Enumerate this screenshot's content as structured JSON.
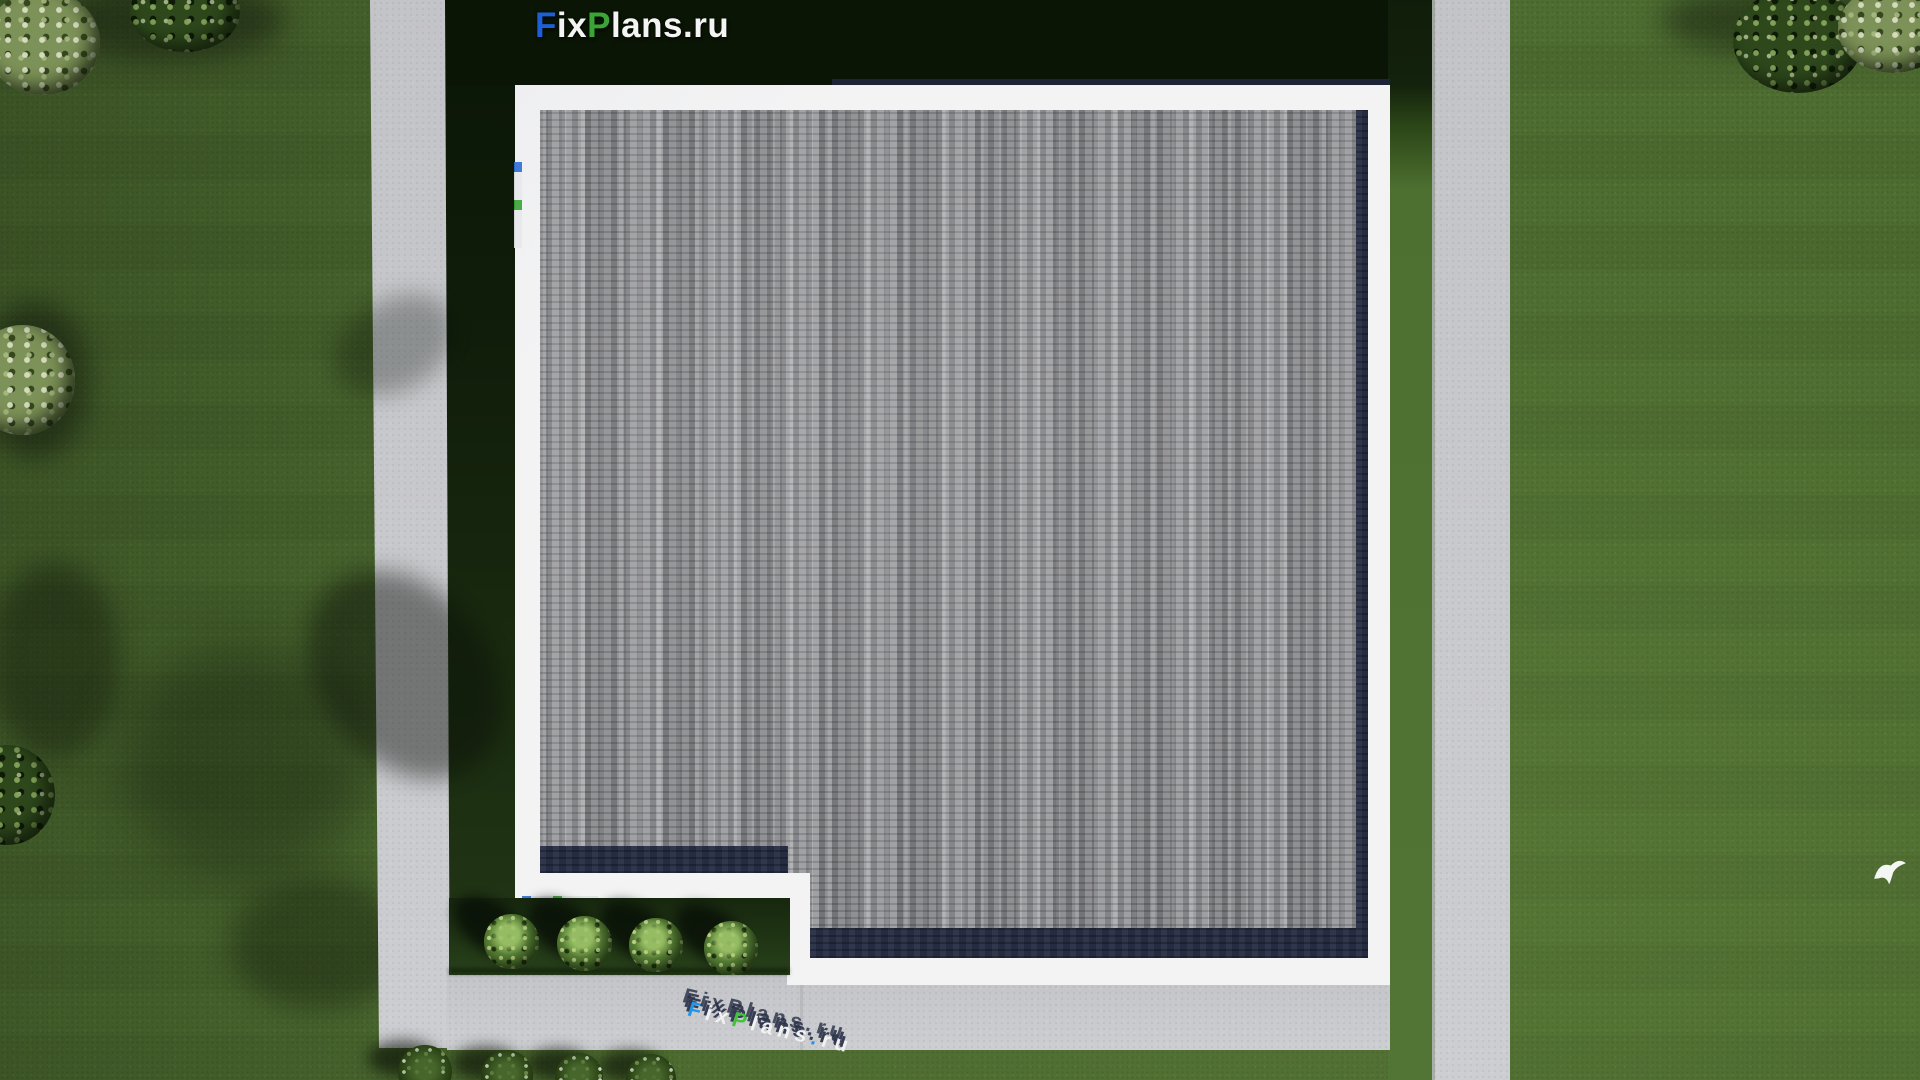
{
  "brand": {
    "name": "FixPlans.ru",
    "segments": [
      {
        "text": "F",
        "color": "#1d5fd6"
      },
      {
        "text": "ix",
        "color": "#f4f4f4"
      },
      {
        "text": "P",
        "color": "#3aa434"
      },
      {
        "text": "lans.ru",
        "color": "#f4f4f4"
      }
    ]
  },
  "ground_logo": {
    "name": "FixPlans.ru",
    "segments": [
      {
        "text": "F",
        "color": "#2196e8"
      },
      {
        "text": "ix",
        "color": "#f2f2f2"
      },
      {
        "text": "P",
        "color": "#43c23c"
      },
      {
        "text": "lans",
        "color": "#f2f2f2"
      },
      {
        "text": ".",
        "color": "#2196e8"
      },
      {
        "text": "ru",
        "color": "#f2f2f2"
      }
    ]
  },
  "scene": {
    "description": "Top-down 3D render of a house: gray shingle roof with white eaves and an L-shaped notch at the bottom-left, concrete paths on the left, bottom and right, lawn with trees, four foundation bushes and a white bird",
    "colors": {
      "lawn": "#4e6d31",
      "lawn_shadow": "#101d0a",
      "pavement": "#cbccd0",
      "eave_white": "#f3f3f4",
      "shingles": "#97989b",
      "fascia_navy": "#252c42",
      "bush_green": "#5b8438",
      "logo_blue": "#1d5fd6",
      "logo_green": "#3aa434"
    },
    "counts": {
      "foundation_bushes": 4,
      "bottom_tree_tops": 4
    }
  }
}
